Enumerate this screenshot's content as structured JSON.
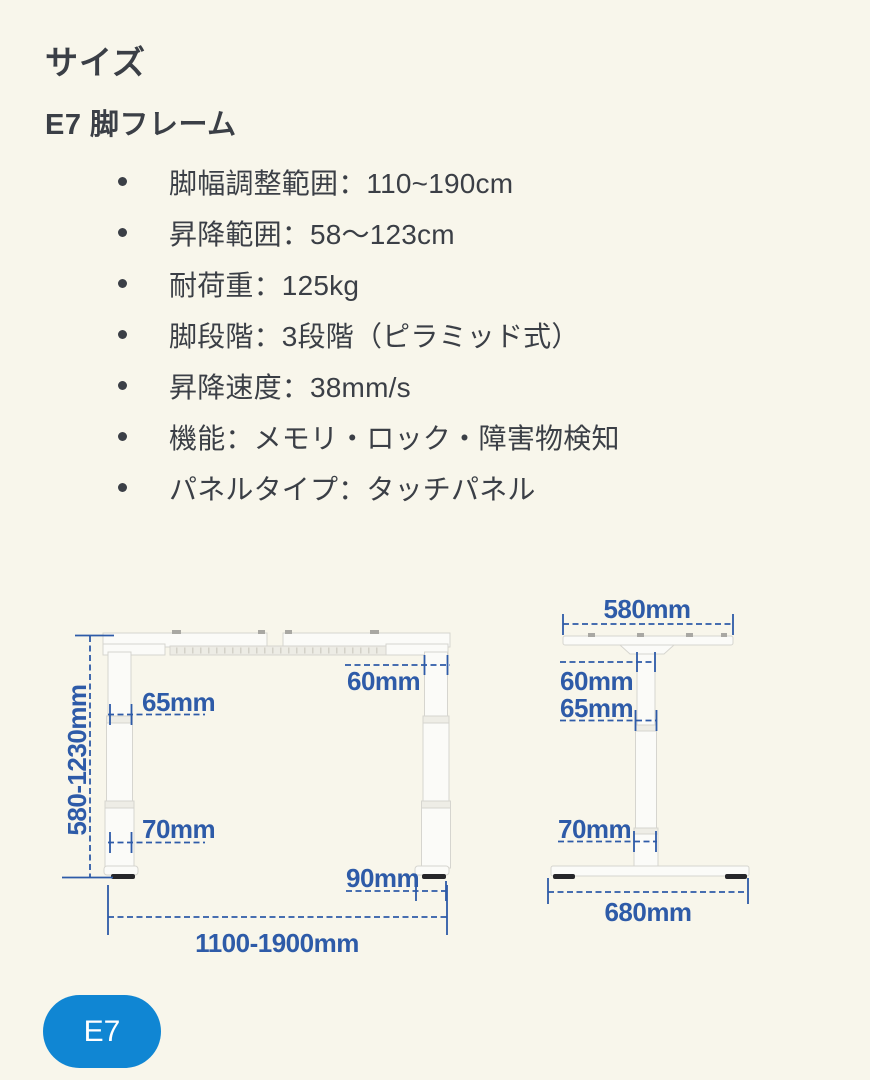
{
  "theme": {
    "background": "#f8f6eb",
    "text_color": "#3b3f46",
    "accent": "#2e5ba8",
    "badge_background": "#1086d3",
    "badge_text_color": "#ffffff",
    "frame_fill": "#fbfbf8",
    "frame_stroke": "#d6d5cf"
  },
  "header": {
    "title": "サイズ",
    "subtitle": "E7 脚フレーム"
  },
  "specs": {
    "items": [
      "脚幅調整範囲：110~190cm",
      "昇降範囲：58〜123cm",
      "耐荷重：125kg",
      "脚段階：3段階（ピラミッド式）",
      "昇降速度：38mm/s",
      "機能：メモリ・ロック・障害物検知",
      "パネルタイプ：タッチパネル"
    ]
  },
  "diagram": {
    "front": {
      "height": "580-1230mm",
      "top_leg": "60mm",
      "mid_leg": "65mm",
      "bottom_leg": "70mm",
      "foot": "90mm",
      "width": "1100-1900mm"
    },
    "side": {
      "top": "580mm",
      "top_col": "60mm",
      "mid_col": "65mm",
      "bottom_col": "70mm",
      "foot": "680mm"
    }
  },
  "badge": {
    "label": "E7"
  }
}
